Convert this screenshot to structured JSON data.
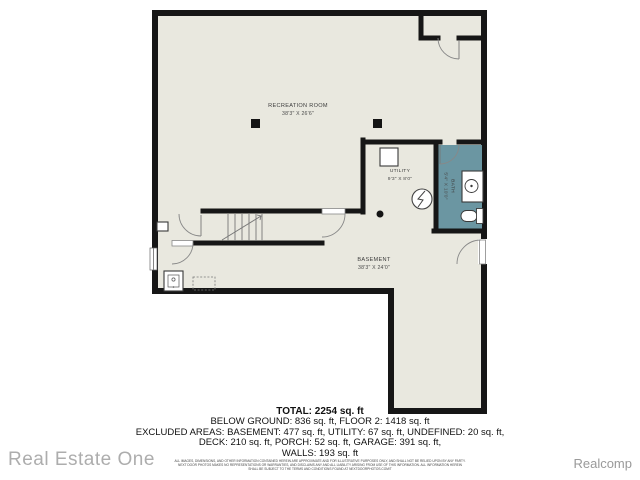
{
  "colors": {
    "floor_fill": "#e9e8df",
    "bath_fill": "#6b96a2",
    "wall": "#161616",
    "watermark": "#adadad"
  },
  "plan": {
    "labels": {
      "recreation": {
        "name": "RECREATION ROOM",
        "dims": "38'3\" X 26'6\""
      },
      "utility": {
        "name": "UTILITY",
        "dims": "9'3\" X 8'0\""
      },
      "bath": {
        "name": "BATH",
        "dims": "5'4\" X 10'0\""
      },
      "basement": {
        "name": "BASEMENT",
        "dims": "38'3\" X 24'0\""
      }
    }
  },
  "summary": {
    "total": "TOTAL: 2254 sq. ft",
    "below_ground": "BELOW GROUND: 836 sq. ft, FLOOR 2: 1418 sq. ft",
    "excluded_1": "EXCLUDED AREAS: BASEMENT: 477 sq. ft, UTILITY: 67 sq. ft, UNDEFINED: 20 sq. ft,",
    "excluded_2": "DECK: 210 sq. ft, PORCH: 52 sq. ft, GARAGE: 391 sq. ft,",
    "walls": "WALLS: 193 sq. ft"
  },
  "disclaimer": {
    "line1": "ALL IMAGES, DIMENSIONS, AND OTHER INFORMATION CONTAINED HEREIN ARE APPROXIMATE AND FOR ILLUSTRATIVE PURPOSES ONLY, AND SHALL NOT BE RELIED UPON BY ANY PARTY.",
    "line2": "NEXT DOOR PHOTOS MAKES NO REPRESENTATIONS OR WARRANTIES, AND DISCLAIMS ANY AND ALL LIABILITY ARISING FROM USE OF THIS INFORMATION. ALL INFORMATION HEREIN",
    "line3": "SHALL BE SUBJECT TO THE TERMS AND CONDITIONS FOUND AT NEXTDOORPHOTOS.COM/T"
  },
  "branding": {
    "left_watermark": "Real Estate One",
    "right_watermark": "Realcomp"
  }
}
